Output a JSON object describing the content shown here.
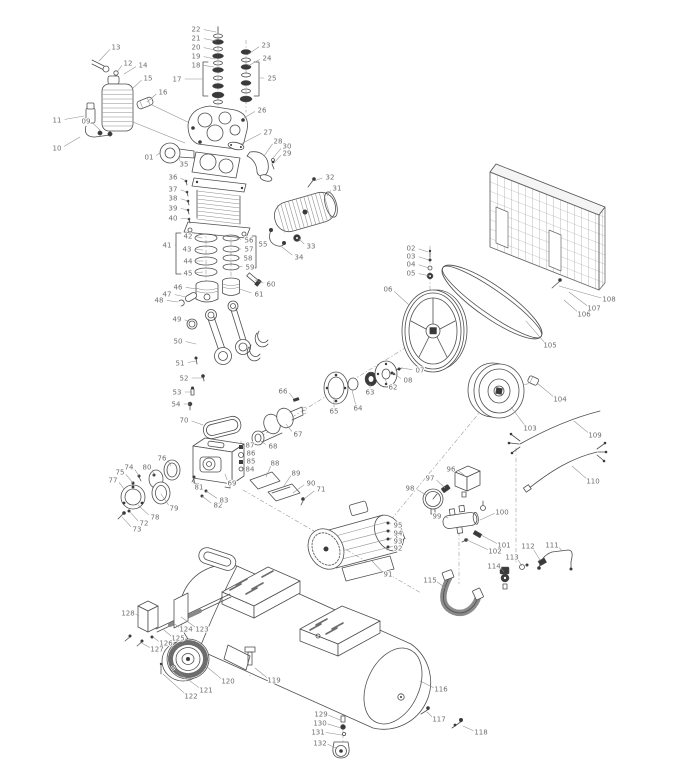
{
  "colors": {
    "background": "#ffffff",
    "line": "#4f4f4f",
    "dark": "#3a3a3a",
    "label": "#6e6e6e",
    "leader": "#8f8f8f"
  },
  "callouts": [
    {
      "n": "01",
      "x": 149,
      "y": 157,
      "tx": 161,
      "ty": 152
    },
    {
      "n": "02",
      "x": 411,
      "y": 248,
      "tx": 428,
      "ty": 252
    },
    {
      "n": "03",
      "x": 411,
      "y": 256,
      "tx": 429,
      "ty": 260
    },
    {
      "n": "04",
      "x": 411,
      "y": 264,
      "tx": 429,
      "ty": 268
    },
    {
      "n": "05",
      "x": 411,
      "y": 273,
      "tx": 430,
      "ty": 276
    },
    {
      "n": "06",
      "x": 388,
      "y": 289,
      "tx": 409,
      "ty": 305
    },
    {
      "n": "07",
      "x": 420,
      "y": 370,
      "tx": 401,
      "ty": 368
    },
    {
      "n": "08",
      "x": 408,
      "y": 380,
      "tx": 393,
      "ty": 373
    },
    {
      "n": "09",
      "x": 86,
      "y": 121,
      "tx": 100,
      "ty": 130
    },
    {
      "n": "10",
      "x": 57,
      "y": 148,
      "tx": 80,
      "ty": 137
    },
    {
      "n": "11",
      "x": 57,
      "y": 120,
      "tx": 84,
      "ty": 116
    },
    {
      "n": "12",
      "x": 128,
      "y": 63,
      "tx": 117,
      "ty": 72
    },
    {
      "n": "13",
      "x": 116,
      "y": 47,
      "tx": 99,
      "ty": 61
    },
    {
      "n": "14",
      "x": 143,
      "y": 65,
      "tx": 124,
      "ty": 74
    },
    {
      "n": "15",
      "x": 148,
      "y": 78,
      "tx": 132,
      "ty": 89
    },
    {
      "n": "16",
      "x": 163,
      "y": 92,
      "tx": 147,
      "ty": 102
    },
    {
      "n": "17",
      "x": 177,
      "y": 79,
      "tx": 202,
      "ty": 79
    },
    {
      "n": "18",
      "x": 196,
      "y": 65,
      "tx": 214,
      "ty": 67
    },
    {
      "n": "19",
      "x": 196,
      "y": 56,
      "tx": 215,
      "ty": 59
    },
    {
      "n": "20",
      "x": 196,
      "y": 47,
      "tx": 215,
      "ty": 50
    },
    {
      "n": "21",
      "x": 196,
      "y": 38,
      "tx": 216,
      "ty": 41
    },
    {
      "n": "22",
      "x": 196,
      "y": 29,
      "tx": 216,
      "ty": 32
    },
    {
      "n": "23",
      "x": 266,
      "y": 45,
      "tx": 247,
      "ty": 55
    },
    {
      "n": "24",
      "x": 267,
      "y": 58,
      "tx": 248,
      "ty": 66
    },
    {
      "n": "25",
      "x": 272,
      "y": 78,
      "tx": 260,
      "ty": 78
    },
    {
      "n": "26",
      "x": 262,
      "y": 110,
      "tx": 244,
      "ty": 118
    },
    {
      "n": "27",
      "x": 268,
      "y": 132,
      "tx": 241,
      "ty": 144
    },
    {
      "n": "28",
      "x": 278,
      "y": 141,
      "tx": 264,
      "ty": 156
    },
    {
      "n": "29",
      "x": 287,
      "y": 153,
      "tx": 274,
      "ty": 163
    },
    {
      "n": "30",
      "x": 287,
      "y": 146,
      "tx": 273,
      "ty": 158
    },
    {
      "n": "31",
      "x": 337,
      "y": 188,
      "tx": 327,
      "ty": 196
    },
    {
      "n": "32",
      "x": 330,
      "y": 177,
      "tx": 314,
      "ty": 181
    },
    {
      "n": "33",
      "x": 311,
      "y": 246,
      "tx": 299,
      "ty": 239
    },
    {
      "n": "34",
      "x": 299,
      "y": 257,
      "tx": 282,
      "ty": 247
    },
    {
      "n": "35",
      "x": 184,
      "y": 164,
      "tx": 179,
      "ty": 157
    },
    {
      "n": "36",
      "x": 173,
      "y": 177,
      "tx": 186,
      "ty": 181
    },
    {
      "n": "37",
      "x": 173,
      "y": 189,
      "tx": 187,
      "ty": 192
    },
    {
      "n": "38",
      "x": 173,
      "y": 198,
      "tx": 188,
      "ty": 201
    },
    {
      "n": "39",
      "x": 173,
      "y": 208,
      "tx": 188,
      "ty": 210
    },
    {
      "n": "40",
      "x": 173,
      "y": 218,
      "tx": 190,
      "ty": 219
    },
    {
      "n": "41",
      "x": 167,
      "y": 245,
      "tx": 176,
      "ty": 245
    },
    {
      "n": "42",
      "x": 188,
      "y": 236,
      "tx": 202,
      "ty": 238
    },
    {
      "n": "43",
      "x": 187,
      "y": 249,
      "tx": 203,
      "ty": 250
    },
    {
      "n": "44",
      "x": 188,
      "y": 261,
      "tx": 203,
      "ty": 261
    },
    {
      "n": "45",
      "x": 188,
      "y": 273,
      "tx": 203,
      "ty": 272
    },
    {
      "n": "46",
      "x": 178,
      "y": 287,
      "tx": 197,
      "ty": 289
    },
    {
      "n": "47",
      "x": 167,
      "y": 294,
      "tx": 186,
      "ty": 297
    },
    {
      "n": "48",
      "x": 159,
      "y": 300,
      "tx": 178,
      "ty": 302
    },
    {
      "n": "49",
      "x": 177,
      "y": 319,
      "tx": 190,
      "ty": 322
    },
    {
      "n": "50",
      "x": 178,
      "y": 341,
      "tx": 196,
      "ty": 344
    },
    {
      "n": "51",
      "x": 180,
      "y": 363,
      "tx": 196,
      "ty": 361
    },
    {
      "n": "52",
      "x": 184,
      "y": 378,
      "tx": 203,
      "ty": 378
    },
    {
      "n": "53",
      "x": 177,
      "y": 392,
      "tx": 192,
      "ty": 392
    },
    {
      "n": "54",
      "x": 176,
      "y": 404,
      "tx": 190,
      "ty": 404
    },
    {
      "n": "55",
      "x": 263,
      "y": 244,
      "tx": 256,
      "ty": 244
    },
    {
      "n": "56",
      "x": 249,
      "y": 240,
      "tx": 237,
      "ty": 238
    },
    {
      "n": "57",
      "x": 249,
      "y": 249,
      "tx": 238,
      "ty": 249
    },
    {
      "n": "58",
      "x": 248,
      "y": 258,
      "tx": 238,
      "ty": 258
    },
    {
      "n": "59",
      "x": 250,
      "y": 267,
      "tx": 238,
      "ty": 266
    },
    {
      "n": "60",
      "x": 271,
      "y": 284,
      "tx": 255,
      "ty": 280
    },
    {
      "n": "61",
      "x": 259,
      "y": 294,
      "tx": 240,
      "ty": 289
    },
    {
      "n": "62",
      "x": 393,
      "y": 387,
      "tx": 385,
      "ty": 379
    },
    {
      "n": "63",
      "x": 370,
      "y": 392,
      "tx": 370,
      "ty": 384
    },
    {
      "n": "64",
      "x": 358,
      "y": 408,
      "tx": 352,
      "ty": 390
    },
    {
      "n": "65",
      "x": 334,
      "y": 411,
      "tx": 334,
      "ty": 397
    },
    {
      "n": "66",
      "x": 283,
      "y": 391,
      "tx": 294,
      "ty": 399
    },
    {
      "n": "67",
      "x": 298,
      "y": 434,
      "tx": 286,
      "ty": 424
    },
    {
      "n": "68",
      "x": 273,
      "y": 446,
      "tx": 261,
      "ty": 441
    },
    {
      "n": "69",
      "x": 232,
      "y": 483,
      "tx": 225,
      "ty": 474
    },
    {
      "n": "70",
      "x": 184,
      "y": 420,
      "tx": 203,
      "ty": 425
    },
    {
      "n": "71",
      "x": 321,
      "y": 489,
      "tx": 304,
      "ty": 499
    },
    {
      "n": "72",
      "x": 144,
      "y": 523,
      "tx": 130,
      "ty": 512
    },
    {
      "n": "73",
      "x": 137,
      "y": 529,
      "tx": 122,
      "ty": 517
    },
    {
      "n": "74",
      "x": 129,
      "y": 467,
      "tx": 139,
      "ty": 476
    },
    {
      "n": "75",
      "x": 120,
      "y": 472,
      "tx": 133,
      "ty": 483
    },
    {
      "n": "76",
      "x": 162,
      "y": 458,
      "tx": 171,
      "ty": 466
    },
    {
      "n": "77",
      "x": 113,
      "y": 480,
      "tx": 124,
      "ty": 489
    },
    {
      "n": "78",
      "x": 155,
      "y": 517,
      "tx": 138,
      "ty": 505
    },
    {
      "n": "79",
      "x": 174,
      "y": 508,
      "tx": 161,
      "ty": 494
    },
    {
      "n": "80",
      "x": 147,
      "y": 467,
      "tx": 154,
      "ty": 475
    },
    {
      "n": "81",
      "x": 199,
      "y": 487,
      "tx": 194,
      "ty": 478
    },
    {
      "n": "82",
      "x": 218,
      "y": 505,
      "tx": 202,
      "ty": 496
    },
    {
      "n": "83",
      "x": 224,
      "y": 500,
      "tx": 206,
      "ty": 491
    },
    {
      "n": "84",
      "x": 250,
      "y": 469,
      "tx": 243,
      "ty": 468
    },
    {
      "n": "85",
      "x": 251,
      "y": 461,
      "tx": 243,
      "ty": 461
    },
    {
      "n": "86",
      "x": 251,
      "y": 453,
      "tx": 243,
      "ty": 453
    },
    {
      "n": "87",
      "x": 250,
      "y": 445,
      "tx": 243,
      "ty": 446
    },
    {
      "n": "88",
      "x": 275,
      "y": 463,
      "tx": 266,
      "ty": 477
    },
    {
      "n": "89",
      "x": 296,
      "y": 473,
      "tx": 284,
      "ty": 486
    },
    {
      "n": "90",
      "x": 311,
      "y": 483,
      "tx": 293,
      "ty": 493
    },
    {
      "n": "91",
      "x": 388,
      "y": 574,
      "tx": 372,
      "ty": 561
    },
    {
      "n": "92",
      "x": 398,
      "y": 548,
      "tx": 390,
      "ty": 547
    },
    {
      "n": "93",
      "x": 398,
      "y": 541,
      "tx": 390,
      "ty": 539
    },
    {
      "n": "94",
      "x": 398,
      "y": 533,
      "tx": 390,
      "ty": 531
    },
    {
      "n": "95",
      "x": 398,
      "y": 525,
      "tx": 390,
      "ty": 523
    },
    {
      "n": "96",
      "x": 451,
      "y": 469,
      "tx": 464,
      "ty": 475
    },
    {
      "n": "97",
      "x": 430,
      "y": 478,
      "tx": 445,
      "ty": 488
    },
    {
      "n": "98",
      "x": 410,
      "y": 488,
      "tx": 426,
      "ty": 495
    },
    {
      "n": "99",
      "x": 437,
      "y": 516,
      "tx": 448,
      "ty": 518
    },
    {
      "n": "100",
      "x": 502,
      "y": 512,
      "tx": 480,
      "ty": 520
    },
    {
      "n": "101",
      "x": 504,
      "y": 545,
      "tx": 481,
      "ty": 535
    },
    {
      "n": "102",
      "x": 495,
      "y": 551,
      "tx": 467,
      "ty": 540
    },
    {
      "n": "103",
      "x": 530,
      "y": 428,
      "tx": 511,
      "ty": 407
    },
    {
      "n": "104",
      "x": 560,
      "y": 399,
      "tx": 537,
      "ty": 383
    },
    {
      "n": "105",
      "x": 550,
      "y": 345,
      "tx": 526,
      "ty": 321
    },
    {
      "n": "106",
      "x": 584,
      "y": 314,
      "tx": 564,
      "ty": 300
    },
    {
      "n": "107",
      "x": 594,
      "y": 308,
      "tx": 569,
      "ty": 292
    },
    {
      "n": "108",
      "x": 609,
      "y": 299,
      "tx": 559,
      "ty": 286
    },
    {
      "n": "109",
      "x": 595,
      "y": 435,
      "tx": 574,
      "ty": 421
    },
    {
      "n": "110",
      "x": 593,
      "y": 481,
      "tx": 572,
      "ty": 466
    },
    {
      "n": "111",
      "x": 552,
      "y": 545,
      "tx": 562,
      "ty": 551
    },
    {
      "n": "112",
      "x": 528,
      "y": 546,
      "tx": 540,
      "ty": 560
    },
    {
      "n": "113",
      "x": 512,
      "y": 557,
      "tx": 522,
      "ty": 566
    },
    {
      "n": "114",
      "x": 494,
      "y": 566,
      "tx": 504,
      "ty": 572
    },
    {
      "n": "115",
      "x": 430,
      "y": 580,
      "tx": 447,
      "ty": 589
    },
    {
      "n": "116",
      "x": 441,
      "y": 689,
      "tx": 420,
      "ty": 681
    },
    {
      "n": "117",
      "x": 439,
      "y": 719,
      "tx": 427,
      "ty": 712
    },
    {
      "n": "118",
      "x": 481,
      "y": 732,
      "tx": 463,
      "ty": 726
    },
    {
      "n": "119",
      "x": 274,
      "y": 680,
      "tx": 255,
      "ty": 668
    },
    {
      "n": "120",
      "x": 228,
      "y": 681,
      "tx": 207,
      "ty": 667
    },
    {
      "n": "121",
      "x": 206,
      "y": 690,
      "tx": 175,
      "ty": 670
    },
    {
      "n": "122",
      "x": 191,
      "y": 696,
      "tx": 163,
      "ty": 674
    },
    {
      "n": "123",
      "x": 202,
      "y": 629,
      "tx": 181,
      "ty": 617
    },
    {
      "n": "124",
      "x": 186,
      "y": 629,
      "tx": 172,
      "ty": 622
    },
    {
      "n": "125",
      "x": 178,
      "y": 638,
      "tx": 164,
      "ty": 630
    },
    {
      "n": "126",
      "x": 166,
      "y": 643,
      "tx": 153,
      "ty": 637
    },
    {
      "n": "127",
      "x": 157,
      "y": 649,
      "tx": 140,
      "ty": 642
    },
    {
      "n": "128",
      "x": 128,
      "y": 613,
      "tx": 139,
      "ty": 616
    },
    {
      "n": "129",
      "x": 321,
      "y": 714,
      "tx": 340,
      "ty": 720
    },
    {
      "n": "130",
      "x": 320,
      "y": 723,
      "tx": 341,
      "ty": 728
    },
    {
      "n": "131",
      "x": 318,
      "y": 732,
      "tx": 342,
      "ty": 735
    },
    {
      "n": "132",
      "x": 320,
      "y": 743,
      "tx": 336,
      "ty": 748
    }
  ]
}
